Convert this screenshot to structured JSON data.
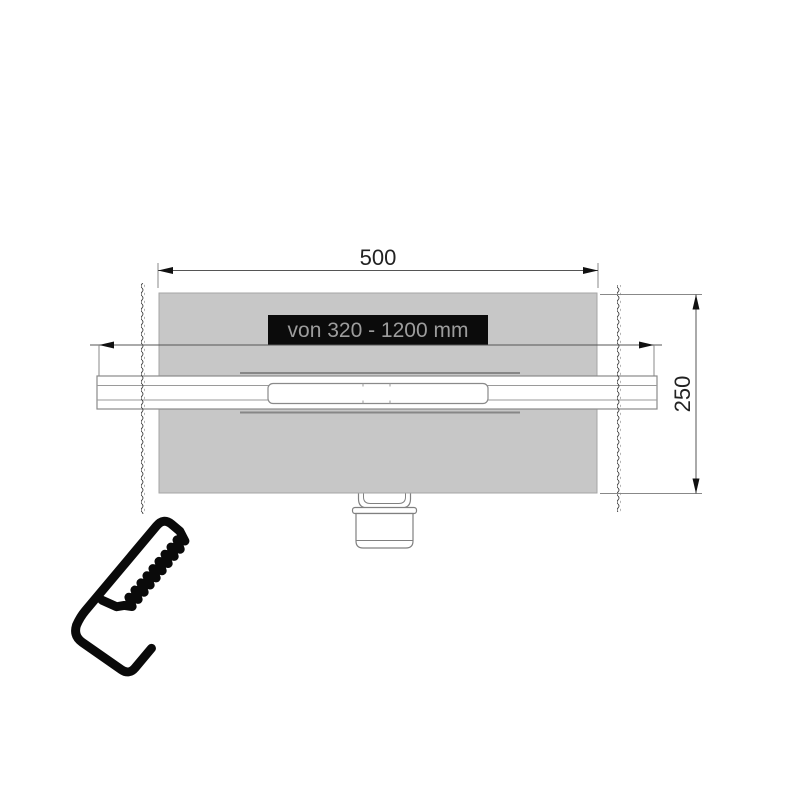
{
  "drawing": {
    "type": "technical-drawing",
    "subject": "linear shower drain channel, plan view",
    "labels": {
      "top_width_dimension": "500",
      "right_height_dimension": "250",
      "adjustable_length_range": "von 320 - 1200 mm"
    },
    "icons": {
      "cut_to_length": "hand-saw-icon"
    },
    "colors": {
      "background": "#ffffff",
      "surface_gray": "#c7c7c7",
      "flange_line_gray": "#878787",
      "outline_gray": "#8a8a8a",
      "label_background": "#0b0b0b",
      "label_text": "#9c9c9c",
      "dimension_line": "#555555",
      "arrow_black": "#111111",
      "icon_black": "#0a0a0a"
    }
  }
}
